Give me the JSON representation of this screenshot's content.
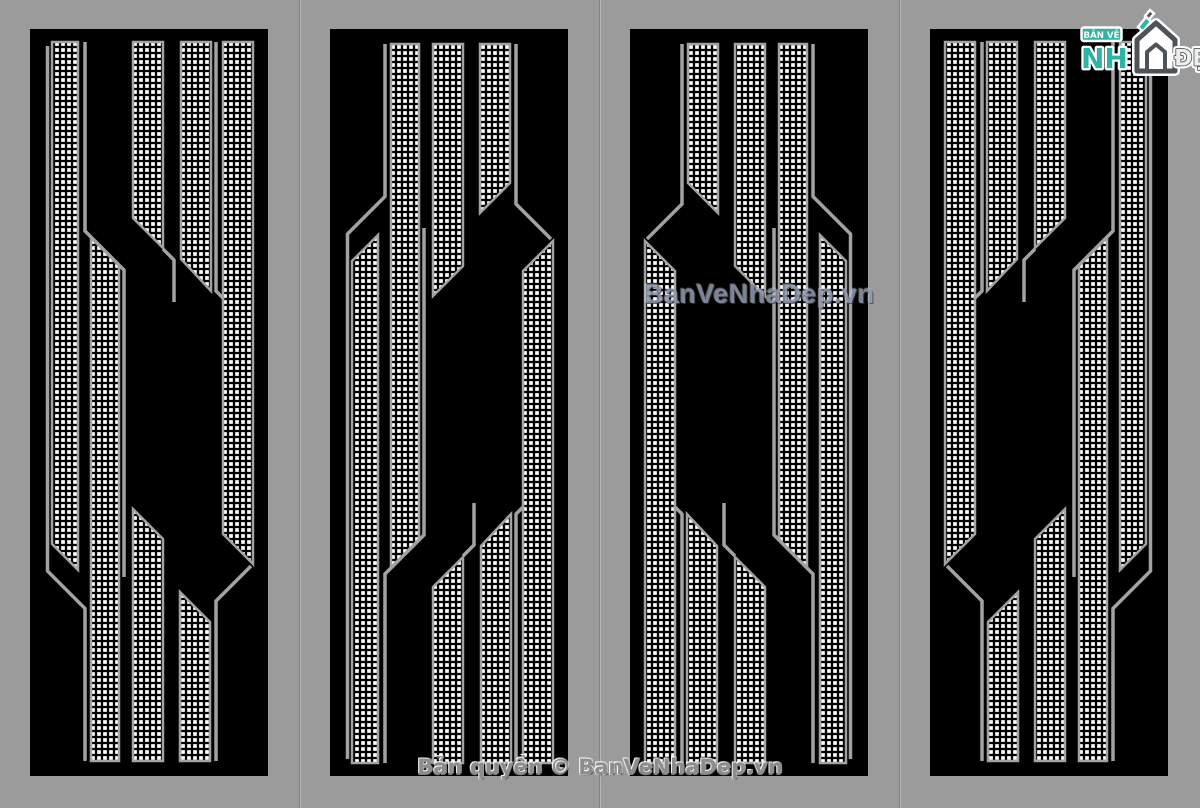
{
  "page": {
    "width": 1200,
    "height": 808,
    "background_color": "#9b9b9b",
    "divider_color": "#828282"
  },
  "artwork": {
    "panel_count": 4,
    "panel_color": "#000000",
    "strip_line_color": "#a2a2a2",
    "perforation_color": "#ffffff",
    "panels": [
      {
        "id": "panel-1",
        "variant": "original"
      },
      {
        "id": "panel-2",
        "variant": "flipped-vertical"
      },
      {
        "id": "panel-3",
        "variant": "flipped-vertical-mirrored"
      },
      {
        "id": "panel-4",
        "variant": "mirrored-horizontal"
      }
    ]
  },
  "watermark": {
    "text": "BanVeNhaDep.vn",
    "color": "#8e99ad"
  },
  "footer": {
    "copyright_text": "Bản quyền © BanVeNhaDep.vn",
    "color": "#8d8d8d"
  },
  "logo": {
    "badge_text": "BẢN VẼ",
    "main_text": "NH",
    "suffix_text": "ĐẸP",
    "teal_color": "#2fb3a3",
    "dark_color": "#4d5357"
  }
}
